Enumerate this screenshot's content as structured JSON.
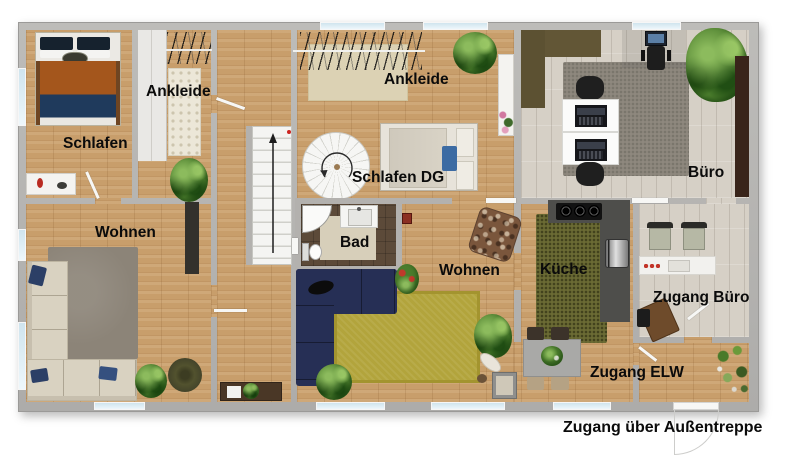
{
  "plan": {
    "labels": {
      "schlafen": "Schlafen",
      "ankleide_left": "Ankleide",
      "ankleide_center": "Ankleide",
      "schlafen_dg": "Schlafen DG",
      "buero": "Büro",
      "wohnen_left": "Wohnen",
      "wohnen_center": "Wohnen",
      "bad": "Bad",
      "kueche": "Küche",
      "zugang_buero": "Zugang Büro",
      "zugang_elw": "Zugang ELW",
      "entrance_note": "Zugang über Außentreppe"
    },
    "colors": {
      "wall": "#b3b1ae",
      "wood": "#c89e6b",
      "tile": "#d6d0c6",
      "window": "#dcedf5",
      "label": "#0b0b0b",
      "rug_olive": "#b2a43c",
      "sofa_navy": "#262f55",
      "sofa_beige": "#d9d2c1",
      "kitchen_counter": "#4e4e4b",
      "bed_blanket_rust": "#a4561c",
      "bed_blanket_navy": "#1f3a5c"
    }
  }
}
